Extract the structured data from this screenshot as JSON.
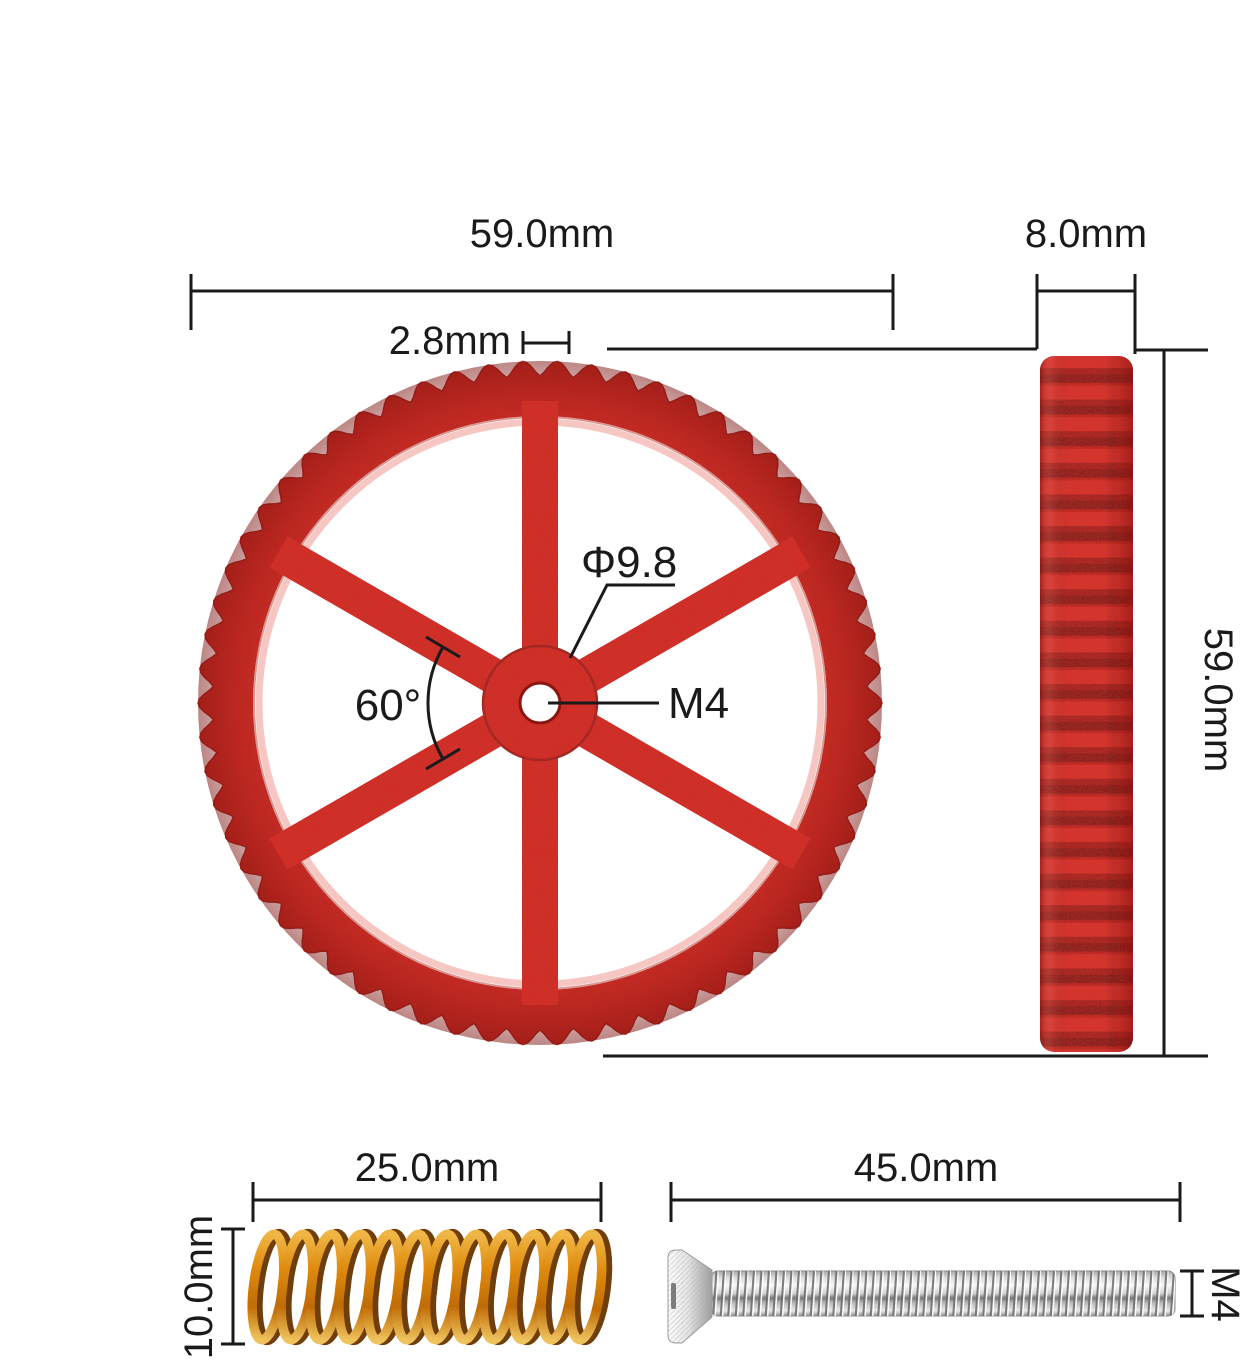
{
  "labels": {
    "wheel_diameter_top": "59.0mm",
    "rim_thickness": "2.8mm",
    "wheel_thickness": "8.0mm",
    "hub_diameter": "Φ9.8",
    "center_thread": "M4",
    "spoke_angle": "60°",
    "wheel_diameter_side": "59.0mm",
    "spring_length": "25.0mm",
    "spring_diameter": "10.0mm",
    "screw_length": "45.0mm",
    "screw_thread": "M4"
  },
  "colors": {
    "background": "#ffffff",
    "dimension_lines": "#1a1a1a",
    "wheel_red": "#d9271f",
    "wheel_dark_red": "#8c1511",
    "spring_orange": "#de8a0d",
    "spring_dark": "#6f3e0b",
    "screw_silver": "#d9d9d9"
  }
}
